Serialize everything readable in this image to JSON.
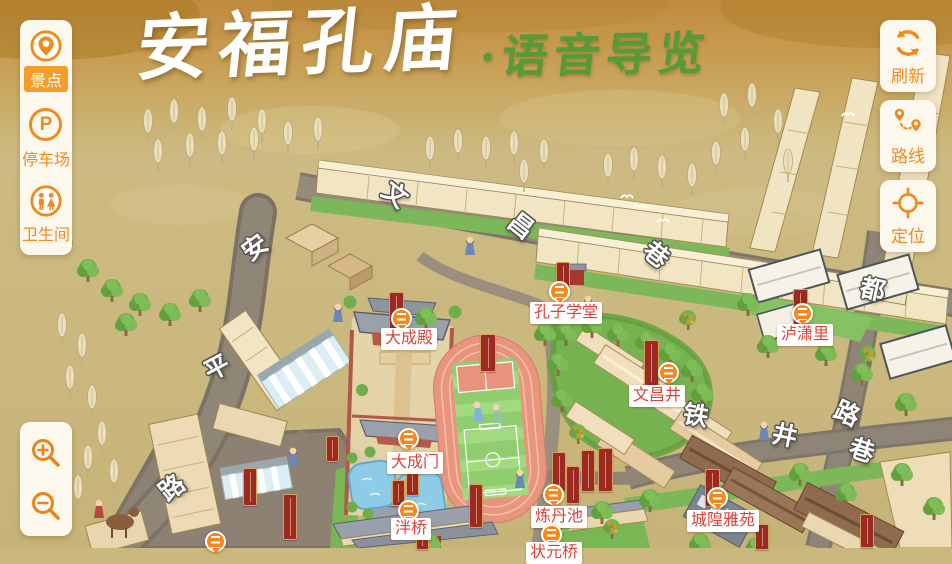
{
  "title": {
    "main": "安福孔庙",
    "sub": "·语音导览"
  },
  "left_toolbar": {
    "items": [
      {
        "id": "scenic",
        "label": "景点",
        "icon": "scenic-marker-icon",
        "selected": true
      },
      {
        "id": "parking",
        "label": "停车场",
        "icon": "parking-icon",
        "icon_letter": "P",
        "selected": false
      },
      {
        "id": "restroom",
        "label": "卫生间",
        "icon": "restroom-icon",
        "selected": false
      }
    ]
  },
  "right_toolbar": {
    "items": [
      {
        "id": "refresh",
        "label": "刷新",
        "icon": "refresh-icon"
      },
      {
        "id": "route",
        "label": "路线",
        "icon": "route-pins-icon"
      },
      {
        "id": "locate",
        "label": "定位",
        "icon": "crosshair-icon"
      }
    ]
  },
  "zoom_controls": {
    "zoom_in_icon": "magnifier-plus-icon",
    "zoom_out_icon": "magnifier-minus-icon"
  },
  "map": {
    "pois": [
      {
        "name": "大成殿"
      },
      {
        "name": "孔子学堂"
      },
      {
        "name": "大成门"
      },
      {
        "name": "泮桥"
      },
      {
        "name": "炼丹池"
      },
      {
        "name": "文昌井"
      },
      {
        "name": "泸潇里"
      },
      {
        "name": "城隍雅苑"
      },
      {
        "name": "状元桥"
      }
    ],
    "streets": {
      "wenchang": {
        "name": "文昌巷",
        "chars": [
          "文",
          "昌",
          "巷"
        ]
      },
      "anping": {
        "name": "安平路",
        "chars": [
          "安",
          "平",
          "路"
        ]
      },
      "dulu": {
        "name": "都路",
        "chars": [
          "都",
          "路"
        ]
      },
      "tiejing": {
        "name": "铁井巷",
        "chars": [
          "铁",
          "井",
          "巷"
        ]
      }
    }
  },
  "colors": {
    "accent_orange": "#ef8a1e",
    "poi_text_red": "#dc4238",
    "banner_red": "#9c2a23",
    "title_green": "#579a38",
    "parchment": "#cbb87f"
  }
}
